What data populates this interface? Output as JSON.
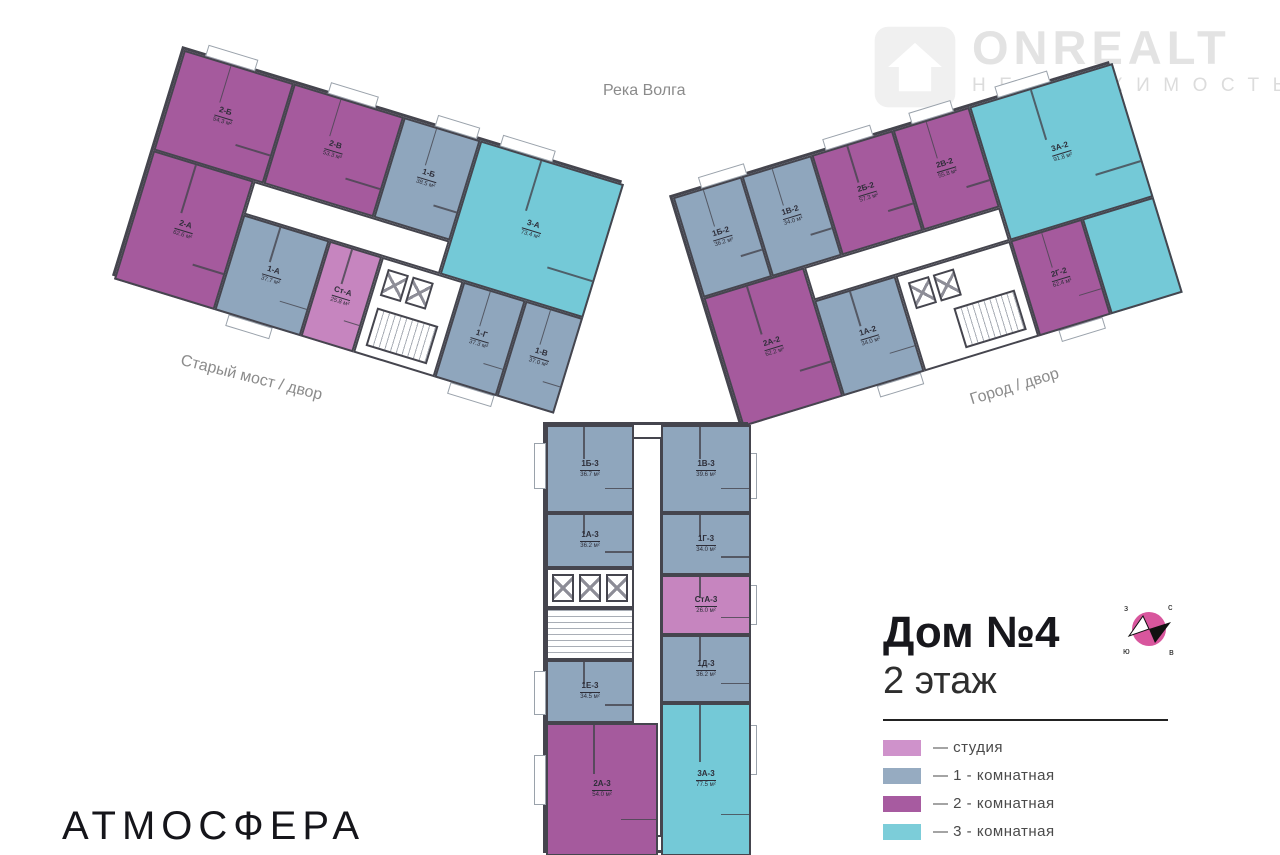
{
  "watermark": {
    "name": "ONREALT",
    "subtitle": "НЕДВИЖИМОСТЬ"
  },
  "brand": "АТМОСФЕРА",
  "environment_labels": {
    "top": "Река Волга",
    "left": "Старый мост / двор",
    "right": "Город / двор"
  },
  "title": {
    "house": "Дом №4",
    "floor": "2 этаж"
  },
  "legend": {
    "items": [
      {
        "label": "— студия",
        "color": "#cf92cb",
        "type": "studio"
      },
      {
        "label": "— 1 - комнатная",
        "color": "#96abc1",
        "type": "1-room"
      },
      {
        "label": "— 2 - комнатная",
        "color": "#a75ba0",
        "type": "2-room"
      },
      {
        "label": "— 3 - комнатная",
        "color": "#7ccdd9",
        "type": "3-room"
      }
    ]
  },
  "colors": {
    "studio": "#c685bf",
    "one_room": "#8fa6bd",
    "two_room": "#a55a9d",
    "three_room": "#74c9d7",
    "walls": "#45454e"
  },
  "compass": {
    "north": "с",
    "east": "в",
    "south": "ю",
    "west": "з"
  },
  "buildings": [
    {
      "name": "building-left",
      "apartments": [
        {
          "id": "2-Б",
          "area": "54.3 м²",
          "type": "2-room"
        },
        {
          "id": "2-В",
          "area": "53.3 м²",
          "type": "2-room"
        },
        {
          "id": "1-Б",
          "area": "38.5 м²",
          "type": "1-room"
        },
        {
          "id": "3-А",
          "area": "73.4 м²",
          "type": "3-room"
        },
        {
          "id": "2-А",
          "area": "62.6 м²",
          "type": "2-room"
        },
        {
          "id": "1-А",
          "area": "37.7 м²",
          "type": "1-room"
        },
        {
          "id": "Ст-А",
          "area": "25.8 м²",
          "type": "studio"
        },
        {
          "id": "1-Г",
          "area": "37.3 м²",
          "type": "1-room"
        },
        {
          "id": "1-В",
          "area": "37.0 м²",
          "type": "1-room"
        }
      ]
    },
    {
      "name": "building-right",
      "apartments": [
        {
          "id": "1Б-2",
          "area": "36.2 м²",
          "type": "1-room"
        },
        {
          "id": "1В-2",
          "area": "34.0 м²",
          "type": "1-room"
        },
        {
          "id": "2Б-2",
          "area": "57.3 м²",
          "type": "2-room"
        },
        {
          "id": "2В-2",
          "area": "55.8 м²",
          "type": "2-room"
        },
        {
          "id": "3А-2",
          "area": "91.8 м²",
          "type": "3-room"
        },
        {
          "id": "2А-2",
          "area": "62.2 м²",
          "type": "2-room"
        },
        {
          "id": "1А-2",
          "area": "34.0 м²",
          "type": "1-room"
        },
        {
          "id": "2Г-2",
          "area": "62.4 м²",
          "type": "2-room"
        }
      ]
    },
    {
      "name": "building-bottom",
      "apartments": [
        {
          "id": "1Б-3",
          "area": "36.7 м²",
          "type": "1-room"
        },
        {
          "id": "1В-3",
          "area": "39.6 м²",
          "type": "1-room"
        },
        {
          "id": "1А-3",
          "area": "36.2 м²",
          "type": "1-room"
        },
        {
          "id": "1Г-3",
          "area": "34.0 м²",
          "type": "1-room"
        },
        {
          "id": "СтА-3",
          "area": "26.0 м²",
          "type": "studio"
        },
        {
          "id": "1Д-3",
          "area": "36.2 м²",
          "type": "1-room"
        },
        {
          "id": "1Е-3",
          "area": "34.5 м²",
          "type": "1-room"
        },
        {
          "id": "2А-3",
          "area": "54.0 м²",
          "type": "2-room"
        },
        {
          "id": "3А-3",
          "area": "77.5 м²",
          "type": "3-room"
        }
      ]
    }
  ]
}
